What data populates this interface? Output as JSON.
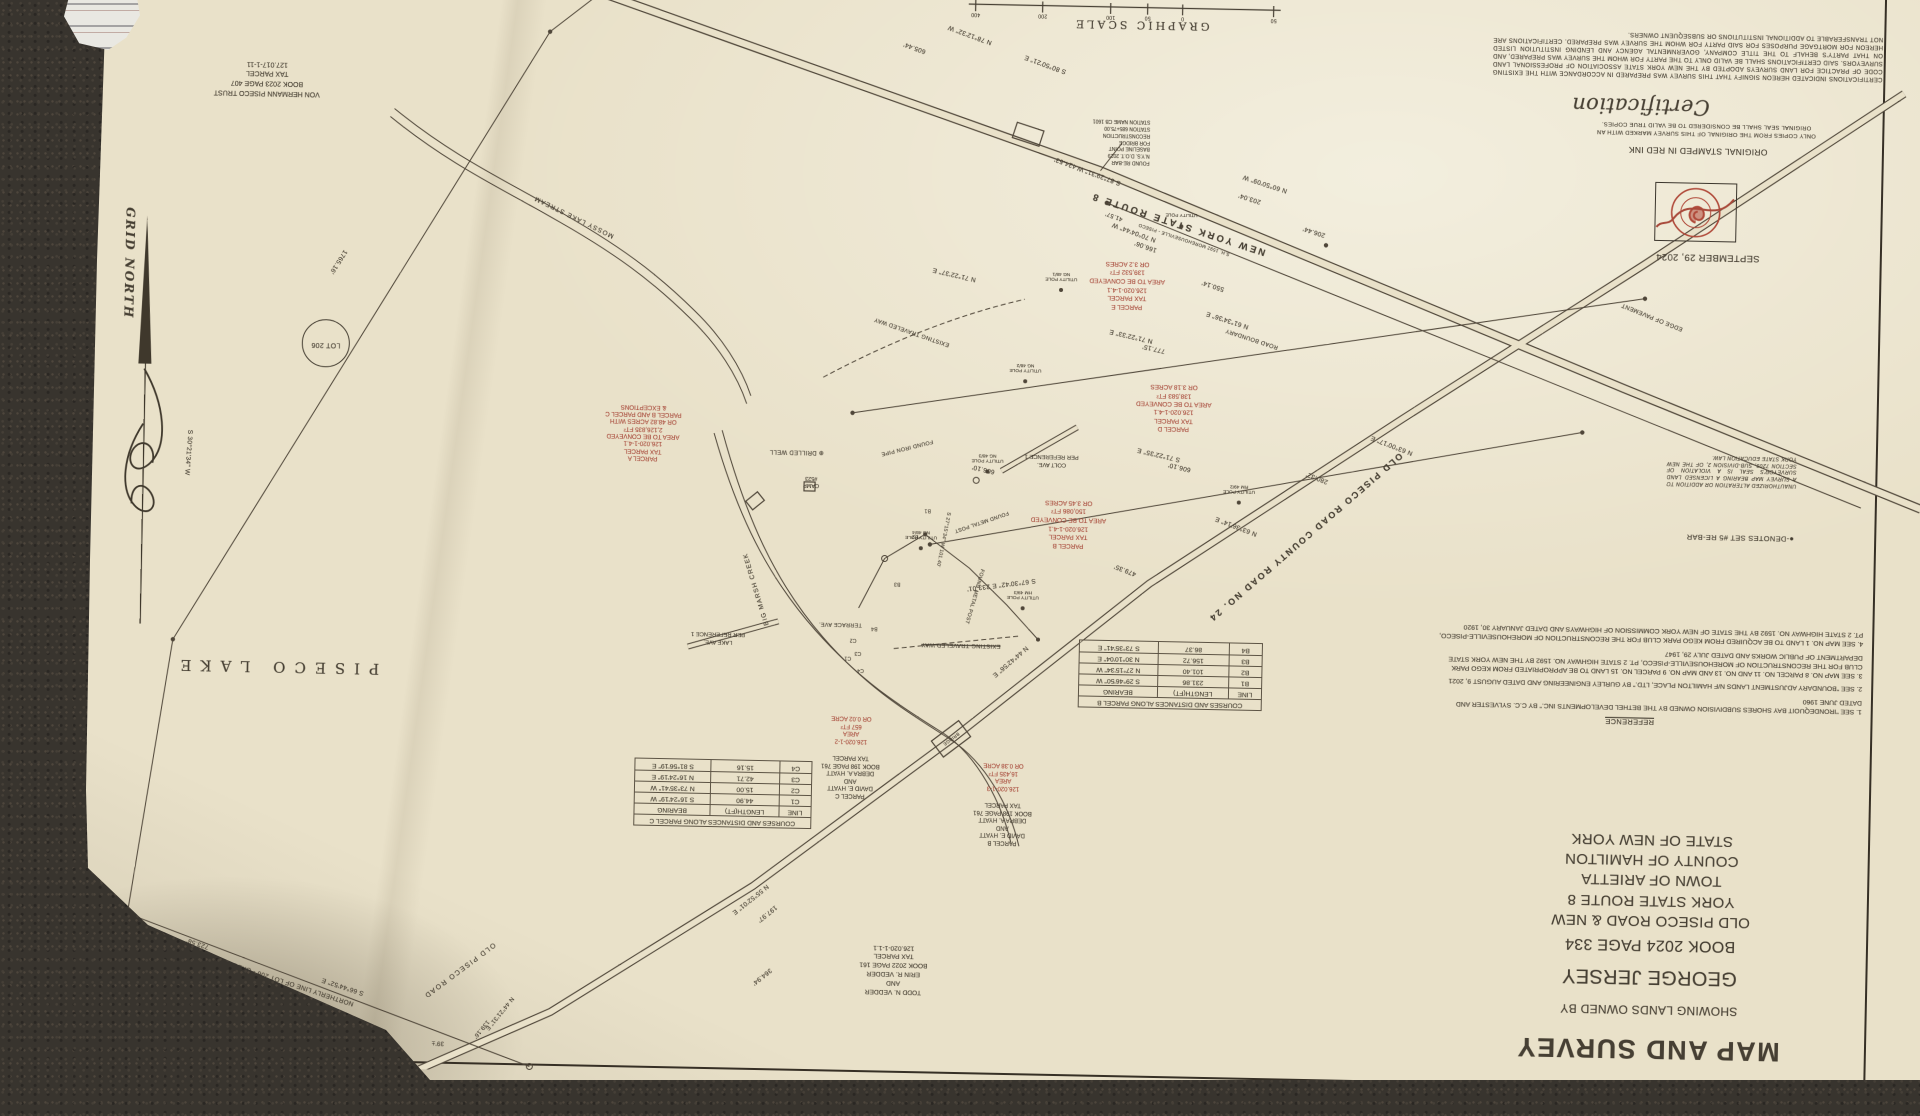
{
  "colors": {
    "carpet": "#38342e",
    "paper": "#e9e1c9",
    "ink": "#463f33",
    "red_ink": "#a8493a"
  },
  "title_block": {
    "title": "MAP AND SURVEY",
    "subtitle": "SHOWING LANDS OWNED BY",
    "owner": "GEORGE JERSEY",
    "deed": "BOOK 2024 PAGE 334",
    "location": "OLD PISECO ROAD & NEW YORK STATE ROUTE 8",
    "town": "TOWN OF ARIETTA",
    "county": "COUNTY OF HAMILTON    STATE OF NEW YORK"
  },
  "certification": {
    "heading": "Certification",
    "body": "CERTIFICATIONS INDICATED HEREON SIGNIFY THAT THIS SURVEY WAS PREPARED IN ACCORDANCE WITH THE EXISTING CODE OF PRACTICE FOR LAND SURVEYS ADOPTED BY THE NEW YORK STATE ASSOCIATION OF PROFESSIONAL LAND SURVEYORS. SAID CERTIFICATIONS SHALL BE VALID ONLY TO THE PARTY FOR WHOM THE SURVEY WAS PREPARED, AND ON THAT PARTY'S BEHALF TO THE TITLE COMPANY, GOVERNMENTAL AGENCY AND LENDING INSTITUTION LISTED HEREON FOR MORTGAGE PURPOSES FOR SAID PARTY FOR WHOM THE SURVEY WAS PREPARED. CERTIFICATIONS ARE NOT TRANSFERABLE TO ADDITIONAL INSTITUTIONS OR SUBSEQUENT OWNERS.",
    "copies_note": "ONLY COPIES FROM THE ORIGINAL OF THIS SURVEY MARKED WITH AN ORIGINAL SEAL SHALL BE CONSIDERED TO BE VALID TRUE COPIES.",
    "stamp_note": "ORIGINAL STAMPED IN RED INK",
    "date": "SEPTEMBER 29, 2024"
  },
  "references": {
    "heading": "REFERENCE",
    "notes": [
      "1. SEE \"IRONDEQUOIT BAY SHORES SUBDIVISION OWNED BY THE BETHEL DEVELOPMENTS INC.\" BY C.C. SYLVESTER AND DATED JUNE 1960",
      "2. SEE \"BOUNDARY ADJUSTMENT LANDS N/F HAMILTON PLACE, LTD.\" BY GURLEY ENGINEERING AND DATED AUGUST 9, 2021",
      "3. SEE MAP NO. 8 PARCEL NO. 11 AND NO. 13 AND MAP NO. 9 PARCEL NO. 15 LAND TO BE APPROPRIATED FROM KEGO PARK CLUB FOR THE RECONSTRUCTION OF MOREHOUSEVILLE-PISECO, PT. 2 STATE HIGHWAY NO. 1592 BY THE NEW YORK STATE DEPARTMENT OF PUBLIC WORKS AND DATED JULY 29, 1947",
      "4. SEE MAP NO. 1 LAND TO BE ACQUIRED FROM KEGO PARK CLUB FOR THE RECONSTRUCTION OF MOREHOUSEVILLE-PISECO, PT. 2 STATE HIGHWAY NO. 1592 BY THE STATE OF NEW YORK COMMISSION OF HIGHWAYS AND DATED JANUARY 30, 1920"
    ]
  },
  "legend": {
    "denotes": "●-DENOTES SET #5 RE-BAR"
  },
  "law_note": "UNAUTHORIZED ALTERATION OR ADDITION TO A SURVEY MAP BEARING A LICENSED LAND SURVEYOR'S SEAL IS A VIOLATION OF SECTION 7209, SUB-DIVISION 2, OF THE NEW YORK STATE EDUCATION LAW.",
  "course_tables": {
    "parcel_b": {
      "title": "COURSES AND DISTANCES ALONG PARCEL B",
      "headers": [
        "LINE",
        "LENGTH(FT)",
        "BEARING"
      ],
      "rows": [
        [
          "B1",
          "231.86",
          "S 29°46'50\" W"
        ],
        [
          "B2",
          "101.40",
          "N 27°15'34\" W"
        ],
        [
          "B3",
          "156.72",
          "N 30°10'04\" E"
        ],
        [
          "B4",
          "86.37",
          "S 73°35'41\" E"
        ]
      ]
    },
    "parcel_c": {
      "title": "COURSES AND DISTANCES ALONG PARCEL C",
      "headers": [
        "LINE",
        "LENGTH(FT)",
        "BEARING"
      ],
      "rows": [
        [
          "C1",
          "44.90",
          "S 16°24'19\" W"
        ],
        [
          "C2",
          "15.00",
          "N 73°35'41\" W"
        ],
        [
          "C3",
          "42.71",
          "N 16°24'19\" E"
        ],
        [
          "C4",
          "15.16",
          "S 81°56'19\" E"
        ]
      ]
    }
  },
  "parcel_areas": {
    "a": "PARCEL A\nTAX PARCEL\n126.020-1-4.1\nAREA TO BE CONVEYED\n2,126,835 FT²\nOR 48.82 ACRES WITH\nPARCEL B AND PARCEL C\n& EXCEPTIONS",
    "b": "PARCEL B\nTAX PARCEL\n126.020-1-4.1\nAREA TO BE CONVEYED\n150,086 FT²\nOR 3.45 ACRES",
    "d": "PARCEL D\nTAX PARCEL\n126.020-1-4.1\nAREA TO BE CONVEYED\n138,583 FT²\nOR 3.18 ACRES",
    "e": "PARCEL E\nTAX PARCEL\n126.020-1-4.1\nAREA TO BE CONVEYED\n139,532 FT²\nOR 3.2 ACRES"
  },
  "owners": {
    "von_hermann": "VON HERMANN PISECO TRUST\nBOOK 2023 PAGE 407\nTAX PARCEL\n127.017-1-11",
    "vedder": "TODD N. VEDDER\nAND\nERIN R. VEDDER\nBOOK 2022 PAGE 161\nTAX PARCEL\n126.020-1-1.1",
    "hyatt_b": "PARCEL B\nDAVID E. HYATT\nAND\nDEBRA A. HYATT\nBOOK 198 PAGE 761\nTAX PARCEL",
    "hyatt_b_area": "126.020-1-3\nAREA\n16,435 FT²\nOR 0.38 ACRE",
    "hyatt_c": "PARCEL C\nDAVID E. HYATT\nAND\nDEBRA A. HYATT\nBOOK 198 PAGE 761\nTAX PARCEL",
    "hyatt_c_area": "126.020-1-2\nAREA\n657 FT²\nOR 0.02 ACRE",
    "people": "PEOPLE OF THE STATE OF NEW YORK\nTAX PARCEL\n119.019-1-19",
    "lot1_deed": "BOOK 2022 PAGE 161\nTAX PARCEL\n126.020-1-1"
  },
  "roads": {
    "route8": "NEW YORK STATE ROUTE 8",
    "route8_sub": "S.H. 1592  MOREHOUSEVILLE - PISECO",
    "old_piseco": "OLD PISECO ROAD    COUNTY ROAD NO. 24",
    "old_piseco_sw": "OLD PISECO ROAD",
    "edge_of_pavement": "EDGE OF PAVEMENT",
    "road_boundary": "ROAD BOUNDARY",
    "traveled_way": "EXISTING TRAVELED WAY",
    "northerly_line": "NORTHERLY LINE OF LOT 206 - OXBOW TRACT",
    "colt_ave": "COLT AVE.\nPER REFERENCE 1",
    "lake_ave": "LAKE AVE.\nPER REFERENCE 1",
    "terrace_ave": "TERRACE AVE.",
    "bridge": "BRIDGE"
  },
  "water": {
    "lake": "PISECO LAKE",
    "stream": "MOSSY LAKE STREAM",
    "creek": "BIG MARSH CREEK"
  },
  "features": {
    "lot_206": "LOT 206",
    "grid_north": "GRID NORTH",
    "graphic_scale": "GRAPHIC SCALE",
    "scale_ticks": [
      "50",
      "0",
      "50",
      "100",
      "200",
      "400"
    ],
    "drilled_well": "⊕ DRILLED WELL",
    "camp": "CAMP\n#523",
    "found_iron_pipe": "FOUND IRON PIPE",
    "found_metal_post": "FOUND METAL POST",
    "found_rebar_callout": "FOUND RE-BAR\nN.Y.S. D.O.T. 2019\nBASELINE POINT\nFOR BRIDGE\nRECONSTRUCTION\nSTATION 685+75.00\nSTATION NAME CB 1601",
    "utility_pole": "UTILITY POLE",
    "pole_ids": [
      "NG 48/1",
      "NG 48/2",
      "NG 48/3",
      "NG 48/4",
      "RM 49/2",
      "HM 49/3"
    ],
    "line_markers": [
      "B1",
      "B2",
      "B3",
      "B4",
      "C1",
      "C2",
      "C3",
      "C4"
    ]
  },
  "bearings": [
    "N 78°12'32\" W",
    "605.44'",
    "S 80°50'21\" E",
    "424.53'",
    "S 87°29'31\" W",
    "N 70°04'44\" W",
    "166.06'",
    "41.57'",
    "203.04'",
    "N 60°50'09\" W",
    "N 71°22'37\" E",
    "N 71°22'33\" E",
    "777.15'",
    "S 71°22'35\" E",
    "606.10'",
    "606.10'",
    "550.14'",
    "N 61°34'36\" E",
    "206.44'",
    "280.32'",
    "N 63°00'17\" E",
    "N 63°36'14\" E",
    "479.35'",
    "S 67°30'42\" E  233.01'",
    "N 44°42'56\" E",
    "N 55°52'01\" E",
    "197.97'",
    "364.94'",
    "723.58'",
    "S 66°44'52\" E",
    "N 44°21'31\" E",
    "139.16'",
    "39'±",
    "S 86°44'52\" W  29.00'",
    "1765.16'",
    "S 30°21'34\" W",
    "S 27°15'34\" W  101.40'"
  ]
}
